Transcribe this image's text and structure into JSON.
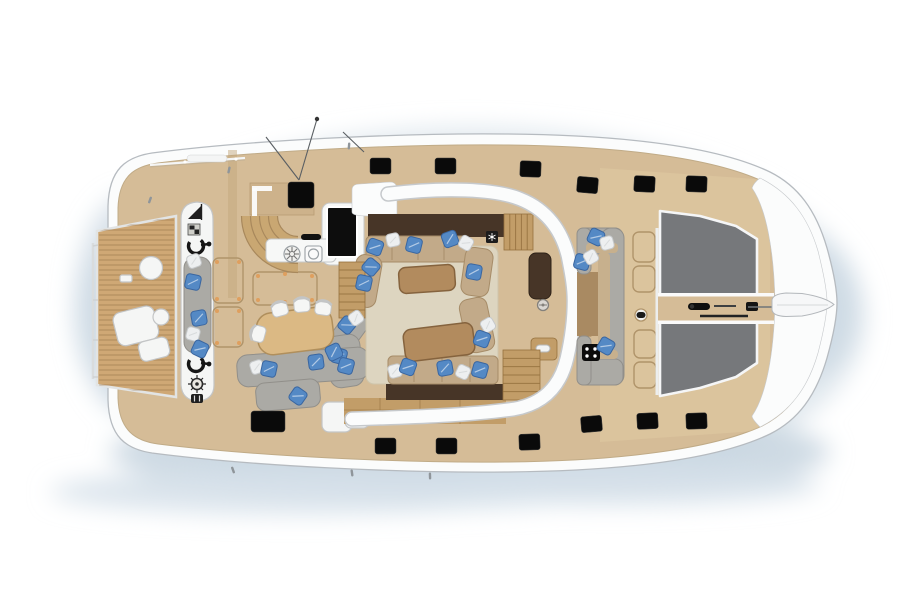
{
  "palette": {
    "bg": "#ffffff",
    "halo": "#dde6ec",
    "halo2": "#c9d6e1",
    "mist": "#d6e1ea",
    "hull": "#fbfcfc",
    "hullStroke": "#b6bbc0",
    "bandEdge": "#c6c9cc",
    "deck": "#d5bc97",
    "deckLight": "#e3cfa8",
    "deckEdge": "#c0ab87",
    "teak": "#cfa875",
    "teakLine": "#8f6d44",
    "wood": "#c29d68",
    "woodLine": "#95713e",
    "cabinet": "#473527",
    "sofaTan": "#c2aa89",
    "sofaTanLine": "#a68c68",
    "backTan": "#c7b08d",
    "rug": "#ddd5c0",
    "rugLine": "#cec5ab",
    "tableWood": "#b28b5e",
    "tableWoodLine": "#85633e",
    "diningTable": "#dbb984",
    "diningTableLine": "#b08f5c",
    "graySofa": "#abaaa5",
    "graySofaLine": "#918f8a",
    "floorBrown": "#a98a62",
    "pillowBlue": "#5489c5",
    "pillowBlueLine": "#3a66a0",
    "pillowWhite": "#edeff0",
    "pillowWhiteLine": "#c6c9cb",
    "tramp": "#76787b",
    "trampLine": "#f5f6f7",
    "hatch": "#0a0a0a",
    "locker": "#b0946a",
    "dot": "#df9f5e",
    "whiteItem": "#f5f6f5",
    "whiteItemLine": "#c3c5c6",
    "glyph": "#1f1f1f",
    "steel": "#8f959a"
  },
  "deck_hatches": {
    "w": 21,
    "h": 16,
    "top": [
      [
        370,
        158,
        0
      ],
      [
        435,
        158,
        0
      ],
      [
        520,
        161,
        2
      ],
      [
        577,
        177,
        5
      ],
      [
        634,
        176,
        3
      ],
      [
        686,
        176,
        2
      ]
    ],
    "bottom": [
      [
        375,
        438,
        0
      ],
      [
        436,
        438,
        0
      ],
      [
        519,
        434,
        -2
      ],
      [
        581,
        416,
        -5
      ],
      [
        637,
        413,
        -3
      ],
      [
        686,
        413,
        -2
      ]
    ]
  },
  "large_hatches": [
    [
      288,
      182,
      26,
      26
    ],
    [
      251,
      411,
      34,
      21
    ]
  ],
  "pillows": {
    "size": 15,
    "items": [
      [
        194,
        261,
        -20,
        "w"
      ],
      [
        193,
        282,
        12,
        "b"
      ],
      [
        199,
        318,
        -10,
        "b"
      ],
      [
        193,
        334,
        15,
        "w"
      ],
      [
        200,
        349,
        25,
        "b"
      ],
      [
        347,
        325,
        40,
        "b"
      ],
      [
        356,
        318,
        -35,
        "w"
      ],
      [
        339,
        356,
        15,
        "b"
      ],
      [
        316,
        362,
        -8,
        "b"
      ],
      [
        257,
        367,
        -18,
        "w"
      ],
      [
        269,
        369,
        12,
        "b"
      ],
      [
        334,
        352,
        -25,
        "b"
      ],
      [
        346,
        366,
        15,
        "b"
      ],
      [
        298,
        396,
        35,
        "b"
      ],
      [
        375,
        247,
        20,
        "b"
      ],
      [
        393,
        240,
        -12,
        "w"
      ],
      [
        414,
        245,
        14,
        "b"
      ],
      [
        450,
        239,
        -20,
        "b"
      ],
      [
        466,
        243,
        30,
        "w"
      ],
      [
        474,
        272,
        10,
        "b"
      ],
      [
        371,
        267,
        40,
        "b"
      ],
      [
        364,
        283,
        12,
        "b"
      ],
      [
        488,
        325,
        -30,
        "w"
      ],
      [
        482,
        339,
        20,
        "b"
      ],
      [
        395,
        371,
        -15,
        "w"
      ],
      [
        408,
        367,
        20,
        "b"
      ],
      [
        445,
        368,
        -10,
        "b"
      ],
      [
        463,
        372,
        25,
        "w"
      ],
      [
        480,
        370,
        15,
        "b"
      ],
      [
        596,
        237,
        25,
        "b"
      ],
      [
        607,
        243,
        -15,
        "w"
      ],
      [
        582,
        262,
        15,
        "b"
      ],
      [
        591,
        257,
        -30,
        "w"
      ],
      [
        606,
        346,
        30,
        "b"
      ]
    ]
  },
  "locker_outlines": [
    [
      213,
      258,
      30,
      45
    ],
    [
      213,
      307,
      30,
      40
    ],
    [
      253,
      272,
      64,
      33
    ],
    [
      633,
      232,
      22,
      30
    ],
    [
      633,
      266,
      22,
      26
    ],
    [
      634,
      330,
      22,
      28
    ],
    [
      634,
      362,
      22,
      26
    ]
  ],
  "locker_dots": [
    [
      217,
      262
    ],
    [
      239,
      262
    ],
    [
      217,
      299
    ],
    [
      239,
      299
    ],
    [
      217,
      311
    ],
    [
      239,
      311
    ],
    [
      217,
      343
    ],
    [
      239,
      343
    ],
    [
      258,
      276
    ],
    [
      285,
      274
    ],
    [
      312,
      276
    ],
    [
      258,
      300
    ],
    [
      285,
      302
    ],
    [
      312,
      300
    ]
  ],
  "steps": [
    [
      504,
      214,
      29,
      36,
      5,
      "v"
    ],
    [
      503,
      350,
      37,
      50,
      6,
      "h"
    ],
    [
      579,
      312,
      12,
      24,
      4,
      "h"
    ],
    [
      339,
      262,
      26,
      56,
      7,
      "h"
    ]
  ],
  "chairs": [
    [
      280,
      310,
      -15
    ],
    [
      302,
      306,
      -5
    ],
    [
      323,
      309,
      8
    ],
    [
      259,
      334,
      -75
    ]
  ],
  "platform": {
    "poly": "97,231 176,216 176,397 97,385",
    "slat_x1": 99,
    "slat_x2": 174,
    "slat_y1": 220,
    "slat_y2": 394,
    "slat_step": 5
  },
  "trampolines": {
    "top": "660,211 700,216 736,226 757,239 757,295 660,295",
    "bottom": "660,322 757,322 757,363 736,377 700,388 660,396"
  },
  "cleats": [
    [
      150,
      200,
      -70
    ],
    [
      229,
      170,
      -78
    ],
    [
      349,
      146,
      -85
    ],
    [
      233,
      470,
      70
    ],
    [
      352,
      473,
      82
    ],
    [
      430,
      476,
      88
    ]
  ],
  "rig_lines": [
    [
      317,
      119,
      299,
      180
    ],
    [
      266,
      137,
      299,
      180
    ],
    [
      343,
      132,
      364,
      152
    ]
  ],
  "seat_dividers": [
    [
      392,
      238,
      392,
      260
    ],
    [
      418,
      238,
      418,
      260
    ],
    [
      444,
      238,
      444,
      260
    ],
    [
      414,
      358,
      414,
      382
    ],
    [
      442,
      358,
      442,
      382
    ],
    [
      470,
      358,
      470,
      382
    ]
  ]
}
